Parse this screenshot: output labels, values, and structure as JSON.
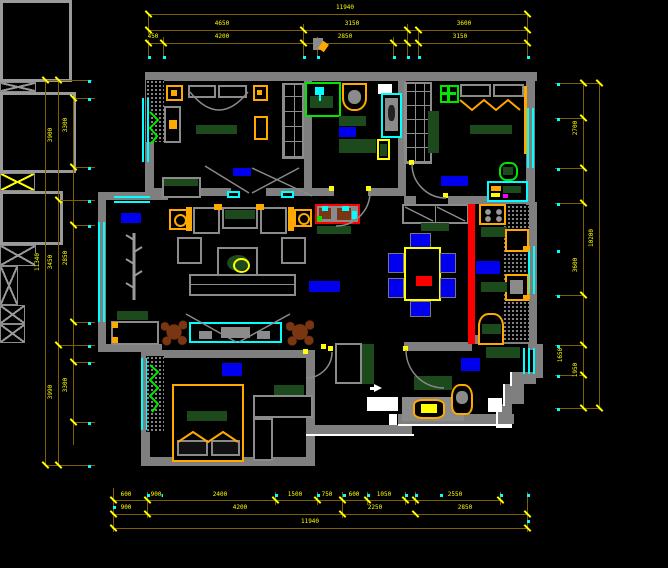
{
  "palette": {
    "wall": "#7f7f7f",
    "dim_line": "#7c5f00",
    "dim_text": "#ffff00",
    "window": "#00ffff",
    "accent_orange": "#ffa800",
    "accent_yellow": "#ffff00",
    "accent_green": "#00e800",
    "dark_green": "#1d4a1d",
    "label_blue": "#0000ee",
    "danger_red": "#ff0000",
    "plant_brown": "#7a3512",
    "white": "#ffffff"
  },
  "dims": {
    "lines": [
      [
        148,
        14,
        527,
        14
      ],
      [
        148,
        30,
        527,
        30
      ],
      [
        148,
        43,
        527,
        43
      ],
      [
        148,
        14,
        148,
        58
      ],
      [
        527,
        14,
        527,
        58
      ],
      [
        303,
        24,
        303,
        58
      ],
      [
        317,
        37,
        317,
        58
      ],
      [
        407,
        24,
        407,
        58
      ],
      [
        418,
        30,
        418,
        58
      ],
      [
        393,
        37,
        393,
        58
      ],
      [
        163,
        37,
        163,
        58
      ],
      [
        45,
        80,
        45,
        465
      ],
      [
        58,
        80,
        58,
        465
      ],
      [
        73,
        98,
        73,
        445
      ],
      [
        45,
        80,
        92,
        80
      ],
      [
        73,
        98,
        95,
        98
      ],
      [
        73,
        167,
        95,
        167
      ],
      [
        58,
        200,
        95,
        200
      ],
      [
        73,
        225,
        95,
        225
      ],
      [
        73,
        322,
        95,
        322
      ],
      [
        58,
        345,
        95,
        345
      ],
      [
        73,
        362,
        95,
        362
      ],
      [
        73,
        422,
        95,
        422
      ],
      [
        45,
        465,
        95,
        465
      ],
      [
        583,
        83,
        583,
        410
      ],
      [
        599,
        83,
        599,
        410
      ],
      [
        555,
        83,
        599,
        83
      ],
      [
        555,
        118,
        583,
        118
      ],
      [
        555,
        168,
        583,
        168
      ],
      [
        555,
        203,
        583,
        203
      ],
      [
        555,
        295,
        583,
        295
      ],
      [
        555,
        345,
        583,
        345
      ],
      [
        555,
        375,
        583,
        375
      ],
      [
        555,
        408,
        599,
        408
      ],
      [
        112,
        500,
        503,
        500
      ],
      [
        112,
        514,
        527,
        514
      ],
      [
        112,
        528,
        527,
        528
      ],
      [
        113,
        488,
        113,
        532
      ],
      [
        147,
        492,
        147,
        518
      ],
      [
        275,
        492,
        275,
        505
      ],
      [
        317,
        492,
        317,
        505
      ],
      [
        342,
        492,
        342,
        518
      ],
      [
        367,
        492,
        367,
        505
      ],
      [
        405,
        492,
        405,
        505
      ],
      [
        415,
        492,
        415,
        505
      ],
      [
        500,
        492,
        500,
        505
      ],
      [
        527,
        492,
        527,
        532
      ]
    ],
    "ticks": [
      [
        148,
        14
      ],
      [
        527,
        14
      ],
      [
        148,
        30
      ],
      [
        303,
        30
      ],
      [
        407,
        30
      ],
      [
        418,
        30
      ],
      [
        527,
        30
      ],
      [
        148,
        43
      ],
      [
        163,
        43
      ],
      [
        303,
        43
      ],
      [
        317,
        43
      ],
      [
        393,
        43
      ],
      [
        407,
        43
      ],
      [
        418,
        43
      ],
      [
        527,
        43
      ],
      [
        45,
        80
      ],
      [
        45,
        465
      ],
      [
        58,
        80
      ],
      [
        58,
        200
      ],
      [
        58,
        345
      ],
      [
        58,
        465
      ],
      [
        73,
        98
      ],
      [
        73,
        167
      ],
      [
        73,
        225
      ],
      [
        73,
        322
      ],
      [
        73,
        362
      ],
      [
        73,
        422
      ],
      [
        583,
        83
      ],
      [
        583,
        118
      ],
      [
        583,
        168
      ],
      [
        583,
        203
      ],
      [
        583,
        295
      ],
      [
        583,
        345
      ],
      [
        583,
        375
      ],
      [
        583,
        408
      ],
      [
        599,
        83
      ],
      [
        599,
        408
      ],
      [
        113,
        500
      ],
      [
        147,
        500
      ],
      [
        275,
        500
      ],
      [
        317,
        500
      ],
      [
        342,
        500
      ],
      [
        367,
        500
      ],
      [
        405,
        500
      ],
      [
        415,
        500
      ],
      [
        500,
        500
      ],
      [
        113,
        514
      ],
      [
        147,
        514
      ],
      [
        342,
        514
      ],
      [
        415,
        514
      ],
      [
        527,
        514
      ],
      [
        113,
        528
      ],
      [
        527,
        528
      ]
    ],
    "dots": [
      [
        148,
        56
      ],
      [
        163,
        56
      ],
      [
        303,
        56
      ],
      [
        317,
        56
      ],
      [
        393,
        56
      ],
      [
        407,
        56
      ],
      [
        418,
        56
      ],
      [
        527,
        56
      ],
      [
        88,
        98
      ],
      [
        88,
        167
      ],
      [
        88,
        225
      ],
      [
        88,
        322
      ],
      [
        88,
        362
      ],
      [
        88,
        422
      ],
      [
        88,
        80
      ],
      [
        88,
        200
      ],
      [
        88,
        345
      ],
      [
        88,
        465
      ],
      [
        557,
        83
      ],
      [
        557,
        118
      ],
      [
        557,
        168
      ],
      [
        557,
        203
      ],
      [
        557,
        250
      ],
      [
        557,
        295
      ],
      [
        557,
        345
      ],
      [
        557,
        375
      ],
      [
        557,
        408
      ],
      [
        147,
        494
      ],
      [
        160,
        494
      ],
      [
        275,
        494
      ],
      [
        317,
        494
      ],
      [
        343,
        494
      ],
      [
        367,
        494
      ],
      [
        405,
        494
      ],
      [
        415,
        494
      ],
      [
        440,
        494
      ],
      [
        500,
        494
      ],
      [
        527,
        494
      ],
      [
        113,
        506
      ],
      [
        527,
        520
      ]
    ],
    "labels": [
      {
        "t": "11940",
        "x": 345,
        "y": 8,
        "r": 0
      },
      {
        "t": "4650",
        "x": 222,
        "y": 24,
        "r": 0
      },
      {
        "t": "3150",
        "x": 352,
        "y": 24,
        "r": 0
      },
      {
        "t": "3600",
        "x": 464,
        "y": 24,
        "r": 0
      },
      {
        "t": "450",
        "x": 153,
        "y": 37,
        "r": 0
      },
      {
        "t": "4200",
        "x": 222,
        "y": 37,
        "r": 0
      },
      {
        "t": "2850",
        "x": 345,
        "y": 37,
        "r": 0
      },
      {
        "t": "3150",
        "x": 460,
        "y": 37,
        "r": 0
      },
      {
        "t": "11340",
        "x": 38,
        "y": 262,
        "r": 1
      },
      {
        "t": "3900",
        "x": 51,
        "y": 135,
        "r": 1
      },
      {
        "t": "3450",
        "x": 51,
        "y": 262,
        "r": 1
      },
      {
        "t": "3990",
        "x": 51,
        "y": 392,
        "r": 1
      },
      {
        "t": "3300",
        "x": 66,
        "y": 125,
        "r": 1
      },
      {
        "t": "2850",
        "x": 66,
        "y": 258,
        "r": 1
      },
      {
        "t": "3300",
        "x": 66,
        "y": 385,
        "r": 1
      },
      {
        "t": "2700",
        "x": 576,
        "y": 128,
        "r": 1
      },
      {
        "t": "10200",
        "x": 592,
        "y": 238,
        "r": 1
      },
      {
        "t": "3600",
        "x": 576,
        "y": 265,
        "r": 1
      },
      {
        "t": "1650",
        "x": 561,
        "y": 355,
        "r": 1
      },
      {
        "t": "1950",
        "x": 576,
        "y": 370,
        "r": 1
      },
      {
        "t": "600",
        "x": 126,
        "y": 495,
        "r": 0
      },
      {
        "t": "900",
        "x": 156,
        "y": 495,
        "r": 0
      },
      {
        "t": "2400",
        "x": 220,
        "y": 495,
        "r": 0
      },
      {
        "t": "1500",
        "x": 295,
        "y": 495,
        "r": 0
      },
      {
        "t": "750",
        "x": 327,
        "y": 495,
        "r": 0
      },
      {
        "t": "600",
        "x": 354,
        "y": 495,
        "r": 0
      },
      {
        "t": "1050",
        "x": 384,
        "y": 495,
        "r": 0
      },
      {
        "t": "2550",
        "x": 455,
        "y": 495,
        "r": 0
      },
      {
        "t": "900",
        "x": 126,
        "y": 508,
        "r": 0
      },
      {
        "t": "4200",
        "x": 240,
        "y": 508,
        "r": 0
      },
      {
        "t": "2250",
        "x": 375,
        "y": 508,
        "r": 0
      },
      {
        "t": "2850",
        "x": 465,
        "y": 508,
        "r": 0
      },
      {
        "t": "11940",
        "x": 310,
        "y": 522,
        "r": 0
      }
    ]
  }
}
